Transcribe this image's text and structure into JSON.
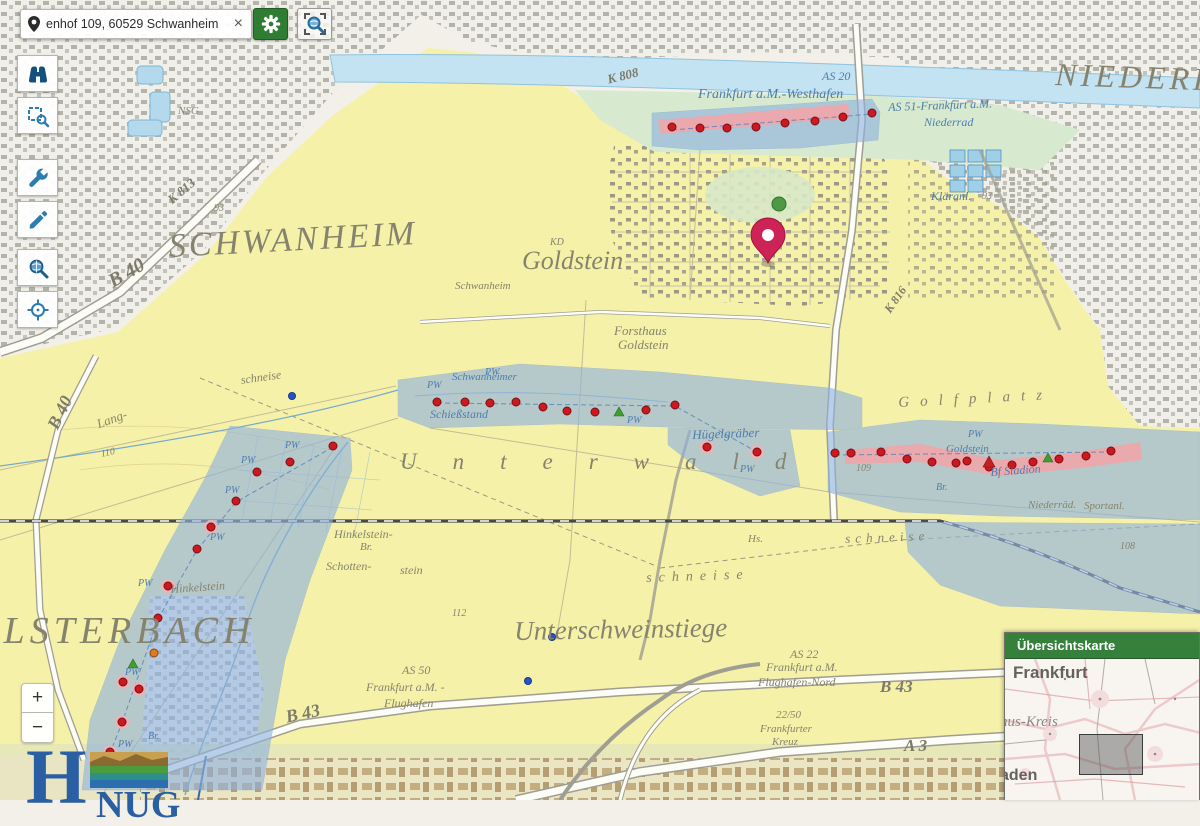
{
  "search_bar": {
    "value": "enhof 109, 60529 Schwanheim",
    "clear_label": "×"
  },
  "toolbar": {
    "items": [
      {
        "id": "search",
        "icon": "binoculars-icon"
      },
      {
        "id": "zoom-select",
        "icon": "zoom-box-icon"
      },
      {
        "id": "tools",
        "icon": "wrench-icon"
      },
      {
        "id": "draw",
        "icon": "pencil-icon"
      },
      {
        "id": "explore",
        "icon": "magnifier-globe-icon"
      },
      {
        "id": "locate",
        "icon": "crosshair-icon"
      }
    ],
    "active_indicator_color": "#3fae2a"
  },
  "zoom_control": {
    "zoom_in": "+",
    "zoom_out": "−"
  },
  "logo": {
    "prefix": "H",
    "suffix": "NUG"
  },
  "overview_panel": {
    "title": "Übersichtskarte",
    "labels": [
      {
        "t": "Frankfurt",
        "x": 8,
        "y": 4,
        "s": 17,
        "c": "ov-city"
      },
      {
        "t": "nus-Kreis",
        "x": -5,
        "y": 55,
        "s": 15,
        "c": "ov-kreis"
      },
      {
        "t": "aden",
        "x": -5,
        "y": 108,
        "s": 16,
        "c": "ov-city"
      }
    ]
  },
  "map": {
    "pin": {
      "x": 768,
      "y": 263
    },
    "colors": {
      "well": "#cc1820",
      "well_ring": "#7d0f14",
      "halo": "#f2b0b4",
      "zone": "#8fb2e0",
      "plume": "#efa5a8",
      "pin": "#ce2357"
    },
    "labels": [
      {
        "t": "SCHWANHEIM",
        "x": 168,
        "y": 230,
        "s": 34,
        "c": "g",
        "ls": 3,
        "r": -3
      },
      {
        "t": "Goldstein",
        "x": 522,
        "y": 248,
        "s": 26,
        "c": "g"
      },
      {
        "t": "NIEDERRAD",
        "x": 1056,
        "y": 58,
        "s": 32,
        "c": "g",
        "ls": 4,
        "r": 2
      },
      {
        "t": "KELSTERBACH",
        "x": -55,
        "y": 612,
        "s": 38,
        "c": "g",
        "ls": 5
      },
      {
        "t": "Unterschweinstiege",
        "x": 514,
        "y": 618,
        "s": 27,
        "c": "g",
        "r": -1
      },
      {
        "t": "Unterwald",
        "x": 400,
        "y": 450,
        "s": 23,
        "c": "g",
        "ls": 36
      },
      {
        "t": "Golfplatz",
        "x": 898,
        "y": 396,
        "s": 15,
        "c": "g",
        "ls": 11,
        "r": -3
      },
      {
        "t": "Forsthaus",
        "x": 614,
        "y": 324,
        "s": 13,
        "c": "g"
      },
      {
        "t": "Goldstein",
        "x": 618,
        "y": 338,
        "s": 13,
        "c": "g"
      },
      {
        "t": "Schwanheim",
        "x": 455,
        "y": 281,
        "s": 11,
        "c": "g"
      },
      {
        "t": "Hinkelstein-",
        "x": 334,
        "y": 528,
        "s": 12,
        "c": "g"
      },
      {
        "t": "Br.",
        "x": 360,
        "y": 542,
        "s": 11,
        "c": "g"
      },
      {
        "t": "Schotten-",
        "x": 326,
        "y": 560,
        "s": 12,
        "c": "g"
      },
      {
        "t": "stein",
        "x": 400,
        "y": 564,
        "s": 12,
        "c": "g"
      },
      {
        "t": "Hinkelstein",
        "x": 170,
        "y": 583,
        "s": 12,
        "c": "g",
        "r": -4
      },
      {
        "t": "schneise",
        "x": 646,
        "y": 572,
        "s": 14,
        "c": "g",
        "ls": 7,
        "r": -2
      },
      {
        "t": "schneise",
        "x": 845,
        "y": 532,
        "s": 13,
        "c": "g",
        "ls": 5,
        "r": -2
      },
      {
        "t": "schneise",
        "x": 240,
        "y": 374,
        "s": 12,
        "c": "g",
        "r": -8
      },
      {
        "t": "Lang-",
        "x": 95,
        "y": 418,
        "s": 13,
        "c": "g",
        "r": -20
      },
      {
        "t": "Hs.",
        "x": 748,
        "y": 534,
        "s": 11,
        "c": "g"
      },
      {
        "t": "NSG",
        "x": 178,
        "y": 106,
        "s": 11,
        "c": "g"
      },
      {
        "t": "KD",
        "x": 550,
        "y": 238,
        "s": 10,
        "c": "g"
      },
      {
        "t": "110",
        "x": 100,
        "y": 450,
        "s": 10,
        "c": "g",
        "r": -12
      },
      {
        "t": "108",
        "x": 1120,
        "y": 542,
        "s": 10,
        "c": "g"
      },
      {
        "t": "112",
        "x": 452,
        "y": 609,
        "s": 10,
        "c": "g"
      },
      {
        "t": "109",
        "x": 856,
        "y": 464,
        "s": 10,
        "c": "g"
      },
      {
        "t": "93",
        "x": 982,
        "y": 192,
        "s": 10,
        "c": "g"
      },
      {
        "t": "93",
        "x": 214,
        "y": 204,
        "s": 10,
        "c": "g"
      },
      {
        "t": "Niederräd.",
        "x": 1028,
        "y": 500,
        "s": 11,
        "c": "g"
      },
      {
        "t": "Sportanl.",
        "x": 1084,
        "y": 501,
        "s": 11,
        "c": "g"
      },
      {
        "t": "Frankfurt a.M.-Westhafen",
        "x": 698,
        "y": 88,
        "s": 14,
        "c": "b"
      },
      {
        "t": "AS 51-Frankfurt a.M.",
        "x": 888,
        "y": 101,
        "s": 12,
        "c": "b",
        "r": -2
      },
      {
        "t": "Niederrad",
        "x": 924,
        "y": 116,
        "s": 12,
        "c": "b"
      },
      {
        "t": "AS 20",
        "x": 822,
        "y": 70,
        "s": 12,
        "c": "b"
      },
      {
        "t": "Kläranl.",
        "x": 931,
        "y": 190,
        "s": 12,
        "c": "b"
      },
      {
        "t": "Schwanheimer",
        "x": 452,
        "y": 372,
        "s": 11,
        "c": "b"
      },
      {
        "t": "Schießstand",
        "x": 430,
        "y": 408,
        "s": 12,
        "c": "b"
      },
      {
        "t": "Hügelgräber",
        "x": 692,
        "y": 428,
        "s": 13,
        "c": "b",
        "r": -2
      },
      {
        "t": "Goldstein",
        "x": 946,
        "y": 444,
        "s": 11,
        "c": "b"
      },
      {
        "t": "Bf Stadion",
        "x": 990,
        "y": 466,
        "s": 12,
        "c": "b",
        "r": -4
      },
      {
        "t": "PW",
        "x": 427,
        "y": 381,
        "s": 10,
        "c": "b"
      },
      {
        "t": "PW",
        "x": 485,
        "y": 368,
        "s": 10,
        "c": "b"
      },
      {
        "t": "PW",
        "x": 627,
        "y": 416,
        "s": 10,
        "c": "b"
      },
      {
        "t": "PW",
        "x": 740,
        "y": 465,
        "s": 10,
        "c": "b"
      },
      {
        "t": "PW",
        "x": 968,
        "y": 430,
        "s": 10,
        "c": "b"
      },
      {
        "t": "PW",
        "x": 285,
        "y": 441,
        "s": 10,
        "c": "b"
      },
      {
        "t": "PW",
        "x": 241,
        "y": 456,
        "s": 10,
        "c": "b"
      },
      {
        "t": "PW",
        "x": 225,
        "y": 486,
        "s": 10,
        "c": "b"
      },
      {
        "t": "PW",
        "x": 210,
        "y": 533,
        "s": 10,
        "c": "b"
      },
      {
        "t": "PW",
        "x": 138,
        "y": 579,
        "s": 10,
        "c": "b"
      },
      {
        "t": "PW",
        "x": 125,
        "y": 668,
        "s": 10,
        "c": "b"
      },
      {
        "t": "PW",
        "x": 118,
        "y": 740,
        "s": 10,
        "c": "b"
      },
      {
        "t": "Br.",
        "x": 936,
        "y": 483,
        "s": 10,
        "c": "b"
      },
      {
        "t": "Br.",
        "x": 148,
        "y": 732,
        "s": 10,
        "c": "b"
      },
      {
        "t": "B 40",
        "x": 105,
        "y": 274,
        "s": 20,
        "c": "r",
        "r": -30
      },
      {
        "t": "B 40",
        "x": 44,
        "y": 424,
        "s": 18,
        "c": "r",
        "r": -64
      },
      {
        "t": "B 43",
        "x": 284,
        "y": 708,
        "s": 18,
        "c": "r",
        "r": -12
      },
      {
        "t": "B 43",
        "x": 880,
        "y": 678,
        "s": 17,
        "c": "r"
      },
      {
        "t": "A 3",
        "x": 904,
        "y": 737,
        "s": 17,
        "c": "r"
      },
      {
        "t": "K 813",
        "x": 165,
        "y": 196,
        "s": 13,
        "c": "r",
        "r": -40
      },
      {
        "t": "K 808",
        "x": 606,
        "y": 73,
        "s": 13,
        "c": "r",
        "r": -14
      },
      {
        "t": "K 816",
        "x": 882,
        "y": 308,
        "s": 12,
        "c": "r",
        "r": -55
      },
      {
        "t": "AS 50",
        "x": 402,
        "y": 664,
        "s": 12,
        "c": "g"
      },
      {
        "t": "Frankfurt a.M. -",
        "x": 366,
        "y": 681,
        "s": 12,
        "c": "g"
      },
      {
        "t": "Flughafen",
        "x": 384,
        "y": 697,
        "s": 12,
        "c": "g"
      },
      {
        "t": "AS 22",
        "x": 790,
        "y": 648,
        "s": 12,
        "c": "g"
      },
      {
        "t": "Frankfurt a.M.",
        "x": 766,
        "y": 661,
        "s": 12,
        "c": "g"
      },
      {
        "t": "Flughafen-Nord",
        "x": 758,
        "y": 676,
        "s": 12,
        "c": "g"
      },
      {
        "t": "22/50",
        "x": 776,
        "y": 710,
        "s": 11,
        "c": "g"
      },
      {
        "t": "Frankfurter",
        "x": 760,
        "y": 724,
        "s": 11,
        "c": "g"
      },
      {
        "t": "Kreuz",
        "x": 772,
        "y": 737,
        "s": 11,
        "c": "g"
      }
    ],
    "wells": [
      [
        672,
        127
      ],
      [
        700,
        128
      ],
      [
        727,
        128
      ],
      [
        756,
        127
      ],
      [
        785,
        123
      ],
      [
        815,
        121
      ],
      [
        843,
        117
      ],
      [
        872,
        113
      ],
      [
        437,
        402
      ],
      [
        465,
        402
      ],
      [
        490,
        403
      ],
      [
        516,
        402
      ],
      [
        543,
        407
      ],
      [
        567,
        411
      ],
      [
        595,
        412
      ],
      [
        646,
        410
      ],
      [
        675,
        405
      ],
      [
        707,
        447,
        1
      ],
      [
        757,
        452,
        1
      ],
      [
        835,
        453
      ],
      [
        851,
        453
      ],
      [
        881,
        452
      ],
      [
        907,
        459
      ],
      [
        932,
        462
      ],
      [
        956,
        463
      ],
      [
        967,
        461
      ],
      [
        989,
        467
      ],
      [
        1012,
        465
      ],
      [
        1033,
        462
      ],
      [
        1059,
        459
      ],
      [
        1086,
        456
      ],
      [
        1111,
        451
      ],
      [
        333,
        446
      ],
      [
        290,
        462
      ],
      [
        257,
        472
      ],
      [
        236,
        501
      ],
      [
        211,
        527,
        1
      ],
      [
        197,
        549
      ],
      [
        168,
        586,
        1
      ],
      [
        158,
        618
      ],
      [
        123,
        682,
        1
      ],
      [
        139,
        689,
        1
      ],
      [
        122,
        722,
        1
      ],
      [
        110,
        752,
        1
      ]
    ],
    "markers": {
      "orange": [
        [
          154,
          653
        ]
      ],
      "blue": [
        [
          552,
          637
        ],
        [
          528,
          681
        ],
        [
          292,
          396
        ]
      ],
      "green_triangles": [
        [
          619,
          412
        ],
        [
          1048,
          458
        ],
        [
          133,
          664
        ]
      ],
      "red_triangles": [
        [
          989,
          462
        ]
      ]
    }
  }
}
